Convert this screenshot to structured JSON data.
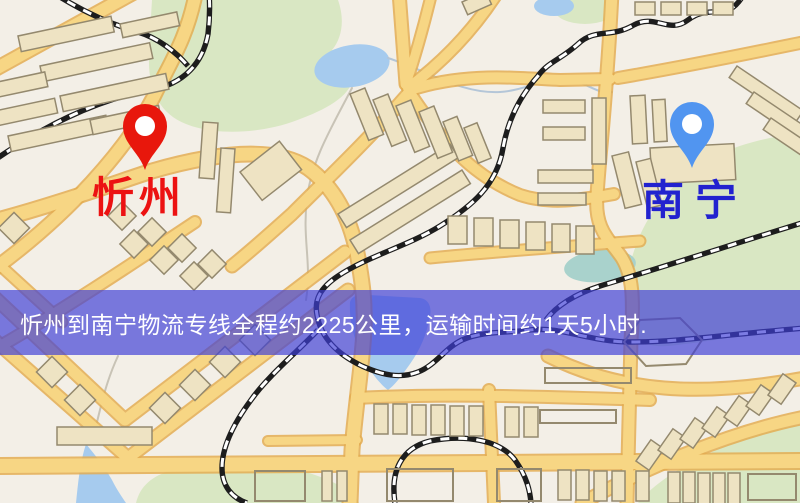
{
  "banner": {
    "text": "忻州到南宁物流专线全程约2225公里，运输时间约1天5小时.",
    "bg_color": "rgba(62,62,215,0.68)",
    "text_color": "#ffffff"
  },
  "markers": [
    {
      "name": "origin",
      "label": "忻州",
      "pin_color": "#e8170c",
      "label_color": "#ec1212"
    },
    {
      "name": "destination",
      "label": "南宁",
      "pin_color": "#5195f0",
      "label_color": "#2222cf"
    }
  ],
  "map_colors": {
    "background": "#f3efe7",
    "road_fill": "#f7d684",
    "road_casing": "#e3ad52",
    "building_fill": "#eee3c3",
    "building_stroke": "#94896e",
    "green_area": "#d9e7c3",
    "water": "#a6cbee",
    "railway_dark": "#1d1d1d",
    "railway_light": "#ffffff"
  }
}
